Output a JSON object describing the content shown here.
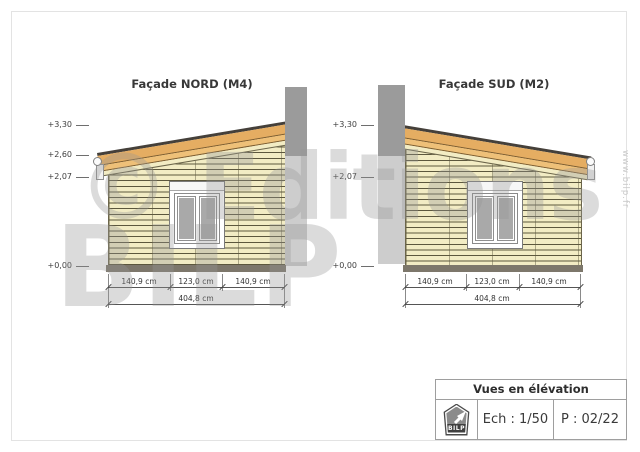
{
  "watermark": {
    "line1": "© Editions",
    "line2": "BILP",
    "website": "www.bilp.fr"
  },
  "facades": [
    {
      "title": "Façade NORD (M4)",
      "elevation_marks": [
        "+3,30",
        "+2,60",
        "+2,07",
        "+0,00"
      ],
      "dimensions": {
        "segments": [
          "140,9 cm",
          "123,0 cm",
          "140,9 cm"
        ],
        "total": "404,8 cm"
      }
    },
    {
      "title": "Façade SUD (M2)",
      "elevation_marks": [
        "+3,30",
        "+2,07",
        "+0,00"
      ],
      "dimensions": {
        "segments": [
          "140,9 cm",
          "123,0 cm",
          "140,9 cm"
        ],
        "total": "404,8 cm"
      }
    }
  ],
  "title_block": {
    "title": "Vues en élévation",
    "logo_text": "BILP",
    "scale": "Ech : 1/50",
    "page": "P : 02/22"
  },
  "colors": {
    "siding": "#f2ecc4",
    "fascia": "#e5ad62",
    "roof_edge": "#45403a",
    "chimney_above_roof": "#9b9b9b",
    "chimney_below_roof": "#cdcdcd",
    "plinth": "#7d776b",
    "glass": "#a9a9a9"
  }
}
